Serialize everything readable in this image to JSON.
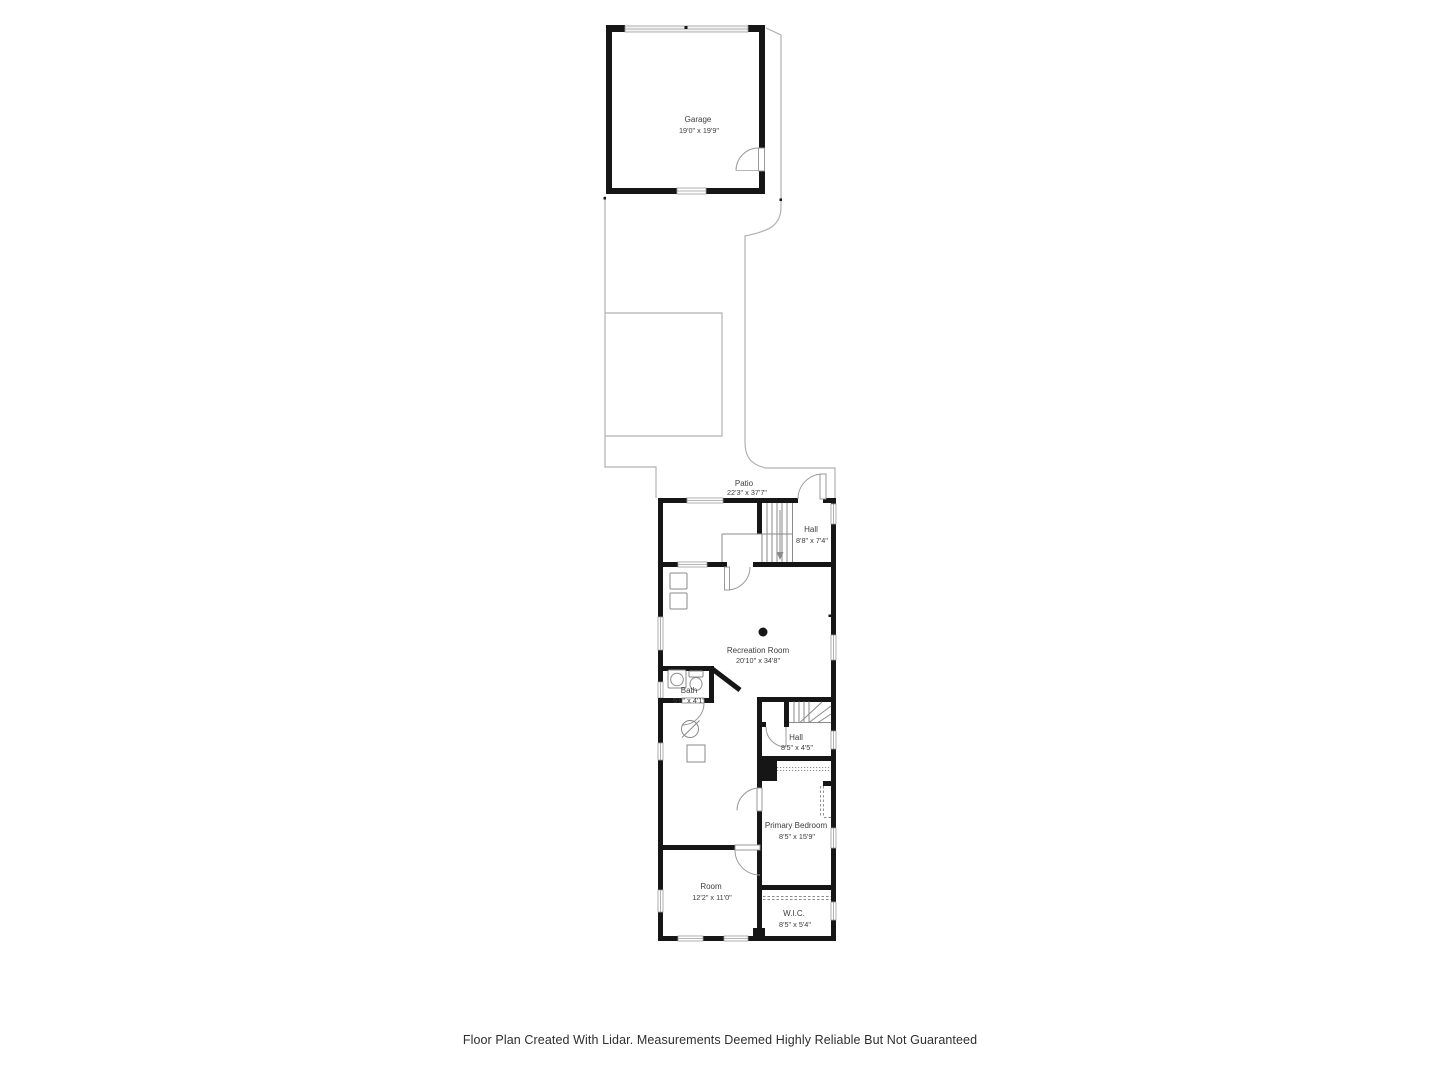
{
  "footer": "Floor Plan Created With Lidar. Measurements Deemed Highly Reliable But Not Guaranteed",
  "colors": {
    "wall": "#161616",
    "outline": "#b0b0b0",
    "symbol": "#8a8a8a",
    "text": "#3d3d3d",
    "background": "#ffffff"
  },
  "rooms": {
    "garage": {
      "name": "Garage",
      "dims": "19'0\" x 19'9\""
    },
    "patio": {
      "name": "Patio",
      "dims": "22'3\" x 37'7\""
    },
    "hall_upper": {
      "name": "Hall",
      "dims": "8'8\" x 7'4\""
    },
    "recreation_room": {
      "name": "Recreation Room",
      "dims": "20'10\" x 34'8\""
    },
    "bath": {
      "name": "Bath",
      "dims": "5'9\" x 4'1\""
    },
    "hall_lower": {
      "name": "Hall",
      "dims": "8'5\" x 4'5\""
    },
    "primary_bedroom": {
      "name": "Primary Bedroom",
      "dims": "8'5\" x 15'9\""
    },
    "room": {
      "name": "Room",
      "dims": "12'2\" x 11'0\""
    },
    "wic": {
      "name": "W.I.C.",
      "dims": "8'5\" x 5'4\""
    }
  }
}
